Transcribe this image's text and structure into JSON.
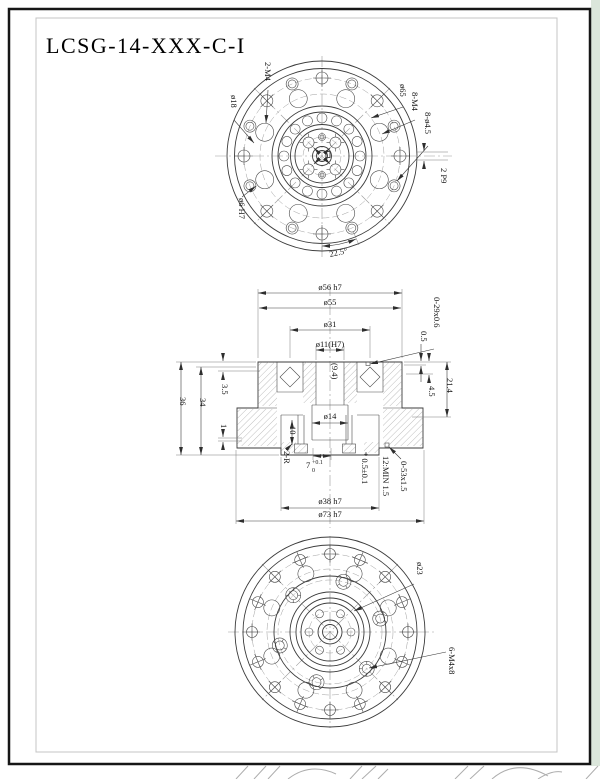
{
  "sheet": {
    "title": "LCSG-14-XXX-C-I",
    "background_color": "#ffffff",
    "margin_color": "#dbe6db",
    "border_color": "#161616",
    "line_color": "#3c3c3c"
  },
  "top_view": {
    "labels": {
      "pin_holes": "2-M4",
      "dia_18": "ø18",
      "dia_65": "ø65",
      "tapped_holes": "8-M4",
      "through_holes": "8-ø4.5",
      "keyway": "2 P9",
      "dia_6_h7": "ø6 H7",
      "hole_angle": "22.5°"
    }
  },
  "section_view": {
    "top_dims": {
      "dia_56": "ø56 h7",
      "dia_55": "ø55",
      "dia_31": "ø31",
      "dia_11": "ø11(H7)"
    },
    "right_dims": {
      "oring_top": "0-29x0.6",
      "step_05": "0.5",
      "depth_45": "4.5",
      "height_214": "21.4"
    },
    "left_dims": {
      "total_height": "36",
      "body_height": "34",
      "plate_35": "3.5",
      "step_1": "1"
    },
    "center_dims": {
      "dia_14": "ø14",
      "depth_10": "10",
      "ref_94": "(9.4)",
      "fillet": "2-R",
      "slot_value": "7",
      "slot_tol_upper": "+0.1",
      "slot_tol_lower": "0"
    },
    "bottom_notes": {
      "note_star": "* 0.5±0.1",
      "note_min": "12:MIN 1.5",
      "oring_bottom": "0-53x1.5"
    },
    "bottom_dims": {
      "dia_38": "ø38 h7",
      "dia_73": "ø73 h7"
    }
  },
  "bottom_view": {
    "labels": {
      "dia_23": "ø23",
      "mounting_screws": "6-M4x8"
    }
  }
}
